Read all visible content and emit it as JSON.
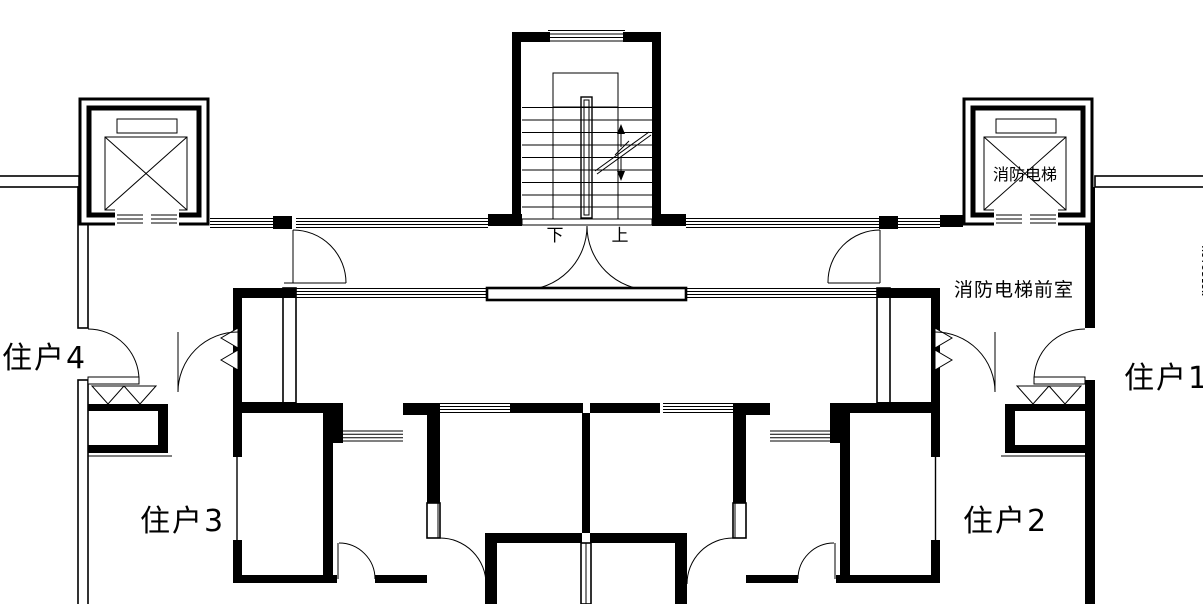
{
  "colors": {
    "line": "#000000",
    "background": "#ffffff"
  },
  "labels": {
    "unit1": "住户1",
    "unit2": "住户2",
    "unit3": "住户3",
    "unit4": "住户4",
    "fire_elevator": "消防电梯",
    "fire_elevator_lobby": "消防电梯前室",
    "stairs_down": "下",
    "stairs_up": "上",
    "watermark": "AUTODESK"
  }
}
